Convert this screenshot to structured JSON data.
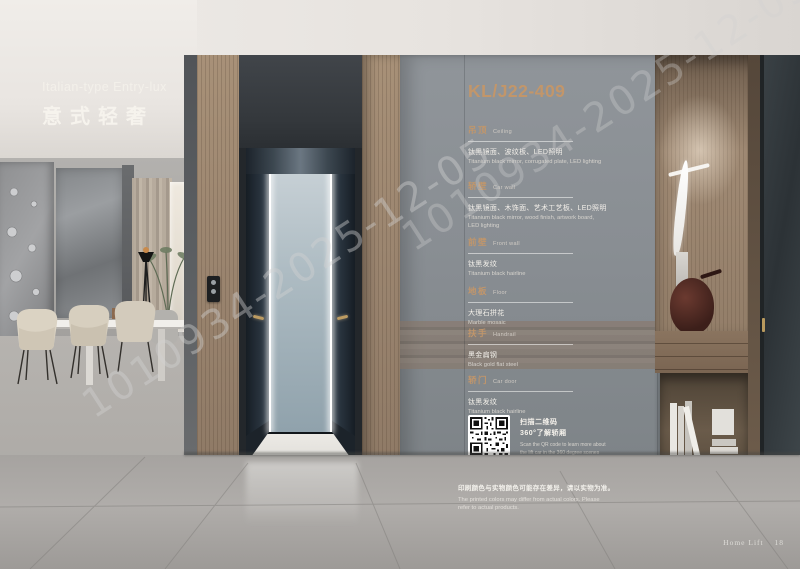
{
  "page": {
    "series_title_en": "Italian-type Entry-lux",
    "series_title_zh": "意式轻奢",
    "watermark": "1010934-2025-12-05",
    "footer_label": "Home Lift",
    "footer_page": "18"
  },
  "spec_panel": {
    "model": "KL/J22-409",
    "sections": [
      {
        "zh": "吊顶",
        "en": "Ceiling",
        "desc_zh": "钛黑镜面、波纹板、LED照明",
        "desc_en": "Titanium black mirror, corrugated plate, LED lighting"
      },
      {
        "zh": "轿壁",
        "en": "Car wall",
        "desc_zh": "钛黑镜面、木饰面、艺术工艺板、LED照明",
        "desc_en": "Titanium black mirror, wood finish, artwork board, LED lighting"
      },
      {
        "zh": "前壁",
        "en": "Front wall",
        "desc_zh": "钛黑发纹",
        "desc_en": "Titanium black hairline"
      },
      {
        "zh": "地板",
        "en": "Floor",
        "desc_zh": "大理石拼花",
        "desc_en": "Marble mosaic"
      },
      {
        "zh": "扶手",
        "en": "Handrail",
        "desc_zh": "黑金扁钢",
        "desc_en": "Black gold flat steel"
      },
      {
        "zh": "轿门",
        "en": "Car door",
        "desc_zh": "钛黑发纹",
        "desc_en": "Titanium black hairline"
      }
    ],
    "qr": {
      "zh1": "扫描二维码",
      "zh2": "360°了解轿厢",
      "en1": "Scan the QR code to learn more about",
      "en2": "the lift car in the 360 degree scenes"
    },
    "disclaimer_zh": "印刷颜色与实物颜色可能存在差异，请以实物为准。",
    "disclaimer_en": "The printed colors may differ from actual colors. Please refer to actual products."
  },
  "colors": {
    "accent_bronze": "#c2966a",
    "panel_gray": "#898e93",
    "wood": "#9c8670",
    "dark_frame": "#33373b",
    "led_white": "#ffffff"
  }
}
